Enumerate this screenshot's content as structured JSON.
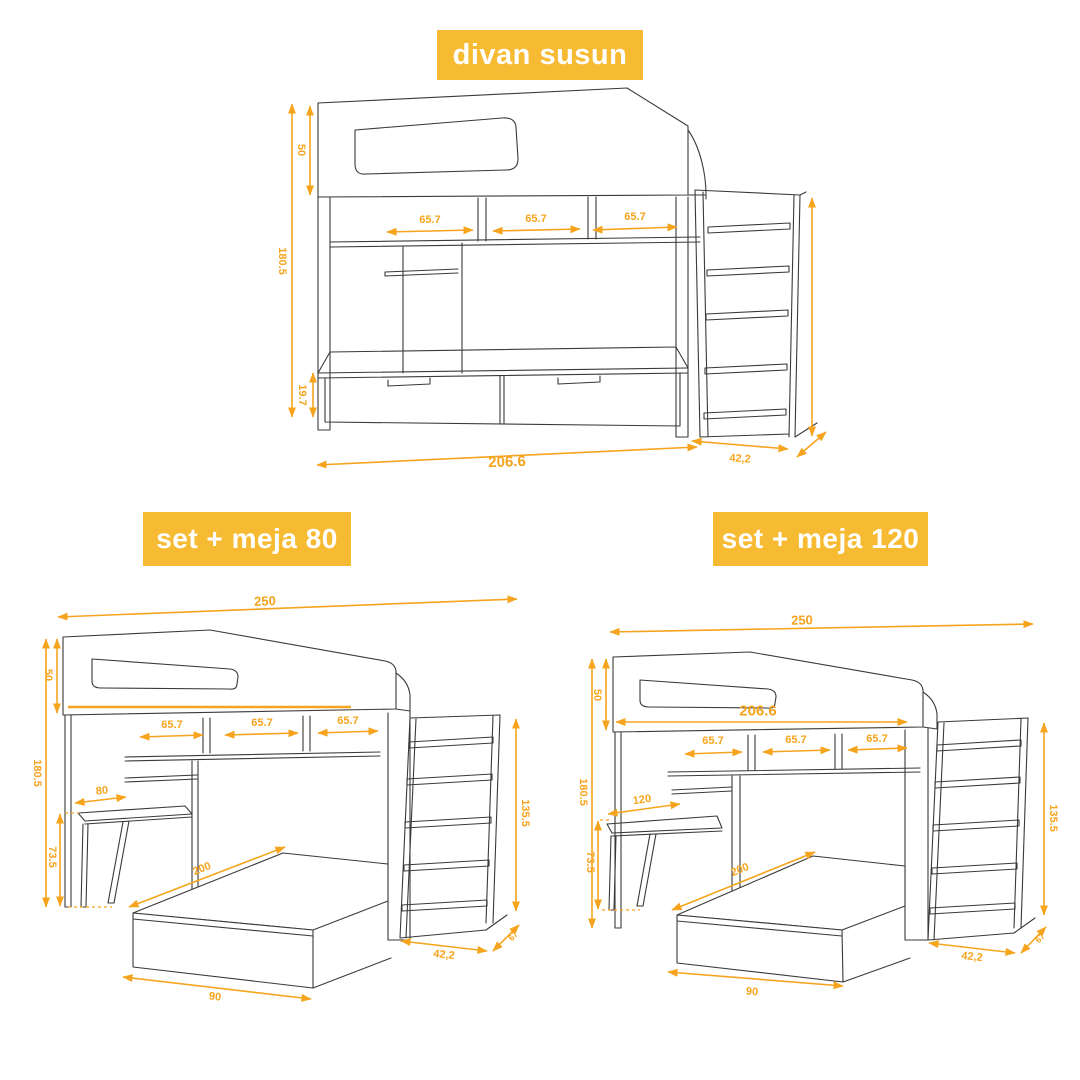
{
  "colors": {
    "background": "#ffffff",
    "banner": "#F7BA33",
    "banner_text": "#ffffff",
    "dimension": "#F6A41E",
    "line": "#3a3a3a"
  },
  "banners": {
    "divan_susun": "divan susun",
    "set_meja_80": "set + meja 80",
    "set_meja_120": "set + meja 120"
  },
  "figures": {
    "divan_susun": {
      "name": "divan susun",
      "dims": {
        "headboard_height": "50",
        "total_height": "180.5",
        "drawer_height": "19.7",
        "overall_width": "206.6",
        "compartment_1": "65.7",
        "compartment_2": "65.7",
        "compartment_3": "65.7",
        "ladder_width": "42,2"
      }
    },
    "set_meja_80": {
      "name": "set + meja 80",
      "dims": {
        "overall_length": "250",
        "headboard_height": "50",
        "total_height": "180.5",
        "compartment_1": "65.7",
        "compartment_2": "65.7",
        "compartment_3": "65.7",
        "desk_width": "80",
        "desk_height": "73.5",
        "bed_length": "200",
        "bed_width": "90",
        "ladder_width": "42,2",
        "ladder_depth": "67",
        "ladder_height": "135.5"
      }
    },
    "set_meja_120": {
      "name": "set + meja 120",
      "dims": {
        "overall_length": "250",
        "bunk_width": "206.6",
        "headboard_height": "50",
        "total_height": "180.5",
        "compartment_1": "65.7",
        "compartment_2": "65.7",
        "compartment_3": "65.7",
        "desk_width": "120",
        "desk_height": "73.5",
        "bed_length": "200",
        "bed_width": "90",
        "ladder_width": "42,2",
        "ladder_depth": "67",
        "ladder_height": "135.5"
      }
    }
  }
}
